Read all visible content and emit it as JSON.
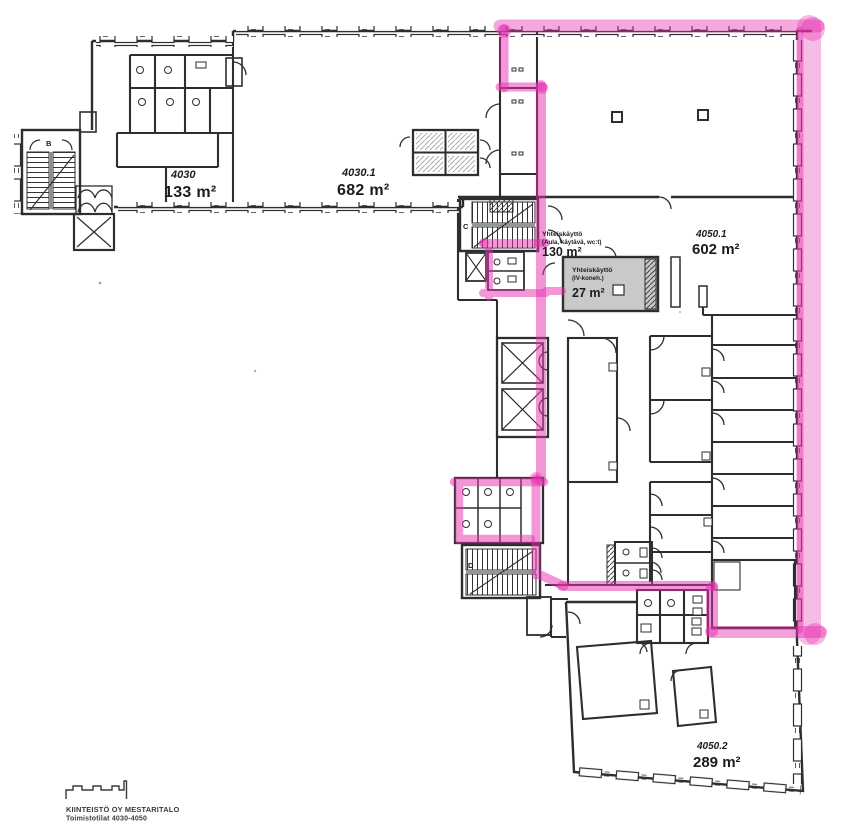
{
  "plan": {
    "units": {
      "u4030": {
        "id": "4030",
        "area": "133 m²"
      },
      "u4030_1": {
        "id": "4030.1",
        "area": "682 m²"
      },
      "u4050_1": {
        "id": "4050.1",
        "area": "602 m²"
      },
      "u4050_2": {
        "id": "4050.2",
        "area": "289 m²"
      }
    },
    "common": {
      "aula": {
        "name": "Yhteiskäyttö",
        "detail": "(Aula, käytävä, wc:t)",
        "area": "130 m²"
      },
      "iv": {
        "name": "Yhteiskäyttö",
        "detail": "(IV-koneh.)",
        "area": "27 m²"
      }
    },
    "stairs": {
      "b": "B",
      "c": "C",
      "d": "D"
    },
    "footer": {
      "company": "KIINTEISTÖ OY MESTARITALO",
      "subtitle": "Toimistotilat 4030-4050"
    },
    "colors": {
      "highlight": "#e62eb0",
      "walls": "#2e2e2e",
      "machine_room_fill": "#c9c9c9"
    }
  }
}
